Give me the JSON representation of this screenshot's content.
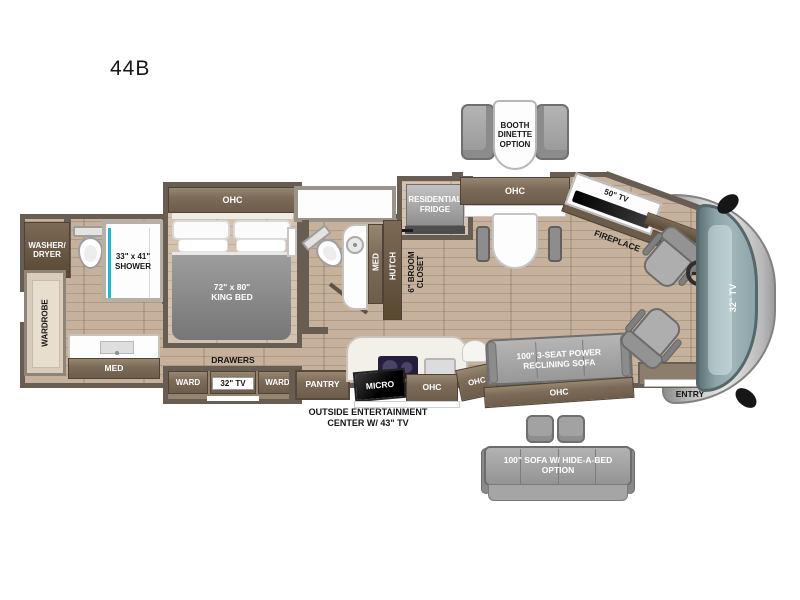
{
  "title": "44B",
  "colors": {
    "wall": "#675d52",
    "floor_wood": "#c2ab94",
    "cabinet_brown": "#7c6b59",
    "shower_accent_teal": "#25b6cc",
    "windshield_teal": "#93aaae",
    "furniture_gray": "#a2a2a2"
  },
  "floorplan": {
    "options": {
      "booth_dinette": "BOOTH\nDINETTE\nOPTION",
      "hide_a_bed_sofa": "100\" SOFA W/ HIDE-A-BED\nOPTION"
    },
    "rear_bath": {
      "washer_dryer": "WASHER/\nDRYER",
      "shower": "33\" x 41\"\nSHOWER",
      "wardrobe": "WARDROBE",
      "med": "MED"
    },
    "bedroom": {
      "ohc": "OHC",
      "king_bed": "72\" x 80\"\nKING BED",
      "drawers": "DRAWERS",
      "ward_left": "WARD",
      "tv": "32\" TV",
      "ward_right": "WARD"
    },
    "mid_bath": {
      "med": "MED",
      "hutch": "HUTCH",
      "broom_closet": "6\" BROOM\nCLOSET"
    },
    "kitchen": {
      "fridge": "RESIDENTIAL\nFRIDGE",
      "pantry": "PANTRY",
      "micro": "MICRO",
      "ohc": "OHC",
      "ohc_corner": "OHC",
      "outside_entertainment": "OUTSIDE ENTERTAINMENT\nCENTER W/ 43\" TV"
    },
    "living": {
      "dinette_ohc": "OHC",
      "tv": "50\" TV",
      "fireplace": "FIREPLACE",
      "sofa": "100\" 3-SEAT POWER\nRECLINING SOFA",
      "sofa_ohc": "OHC"
    },
    "front": {
      "dash_tv": "32\" TV",
      "entry": "ENTRY"
    }
  }
}
